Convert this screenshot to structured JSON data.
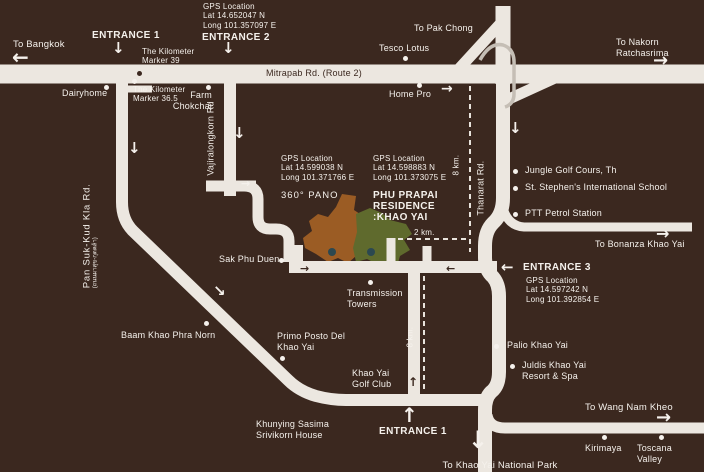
{
  "colors": {
    "background": "#3b281f",
    "road": "#ece7e0",
    "text_light": "#f5f1ec",
    "text_dark": "#3b281f",
    "parcel_orange": "#9b5c24",
    "parcel_green": "#5f6a2d",
    "parcel_dot": "#2c4850",
    "ramp_outline": "#c5beb5"
  },
  "icons": {
    "arrow_left": "←",
    "arrow_right": "→",
    "arrow_up": "↑",
    "arrow_down": "↓",
    "arrow_down_right": "↘"
  },
  "entrances": {
    "top1": "ENTRANCE 1",
    "top2": "ENTRANCE 2",
    "e3": "ENTRANCE 3",
    "bottom1": "ENTRANCE 1"
  },
  "gps_top": {
    "l1": "GPS Location",
    "l2": "Lat 14.652047 N",
    "l3": "Long 101.357097 E"
  },
  "gps_pano": {
    "l1": "GPS Location",
    "l2": "Lat 14.599038 N",
    "l3": "Long 101.371766 E",
    "caption": "360° PANO"
  },
  "gps_residence": {
    "l1": "GPS Location",
    "l2": "Lat 14.598883 N",
    "l3": "Long 101.373075 E",
    "name1": "PHU PRAPAI",
    "name2": "RESIDENCE",
    "name3": ":KHAO YAI"
  },
  "gps_e3": {
    "l1": "GPS Location",
    "l2": "Lat 14.597242 N",
    "l3": "Long 101.392854 E"
  },
  "roads": {
    "mitrapab": "Mitrapab Rd. (Route 2)",
    "pansuk": "Pan Suk-Kud Kla Rd.",
    "pansuk_sub": "(ถนนผาสุข-กุดคล้า)",
    "vajiralongkorn": "Vajiralongkorn Rd",
    "thanarat": "Thanarat Rd."
  },
  "directions": {
    "bangkok": "To Bangkok",
    "pak_chong": "To Pak Chong",
    "nakorn1": "To Nakorn",
    "nakorn2": "Ratchasrima",
    "bonanza": "To Bonanza Khao Yai",
    "wang_nam_kheo": "To Wang Nam Kheo",
    "national_park": "To Khao Yai National Park"
  },
  "markers": {
    "km39_1": "The Kilometer",
    "km39_2": "Marker 39",
    "km365_1": "The Kilometer",
    "km365_2": "Marker 36.5"
  },
  "distances": {
    "eight_right": "8 km.",
    "eight_left": "8 km.",
    "two": "2 km."
  },
  "landmarks": {
    "dairyhome": "Dairyhome",
    "farm1": "Farm",
    "farm2": "Chokchai",
    "tesco": "Tesco Lotus",
    "homepro": "Home Pro",
    "jungle": "Jungle Golf Cours, Th",
    "stephen": "St. Stephen's International School",
    "ptt": "PTT Petrol Station",
    "sak": "Sak Phu Duen",
    "transmission1": "Transmission",
    "transmission2": "Towers",
    "baam": "Baam Khao Phra Norn",
    "primo1": "Primo Posto Del",
    "primo2": "Khao Yai",
    "golf1": "Khao Yai",
    "golf2": "Golf Club",
    "khunying1": "Khunying Sasima",
    "khunying2": "Srivikorn House",
    "palio": "Palio Khao Yai",
    "juldis1": "Juldis Khao Yai",
    "juldis2": "Resort & Spa",
    "kirimaya": "Kirimaya",
    "toscana1": "Toscana",
    "toscana2": "Valley"
  }
}
